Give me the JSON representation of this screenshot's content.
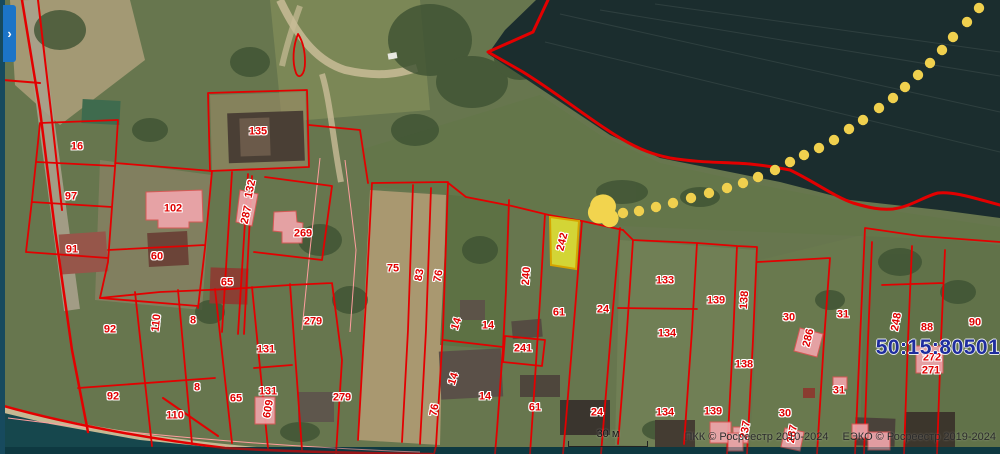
{
  "panel": {
    "expand_chevron": "›"
  },
  "map": {
    "quarter_label": "50:15:80501",
    "scale_bar_label": "30 м",
    "attribution": [
      "ПКК © Росреестр 2010-2024",
      "ЕЭКО © Росреестр 2019-2024"
    ],
    "selected_parcel": {
      "label": "242"
    },
    "colors": {
      "boundary_red": "#e30000",
      "label_red": "#e00000",
      "pink_building_fill": "#f2a6ad",
      "pink_building_stroke": "#e05555",
      "selected_fill": "#e6e632",
      "selected_stroke": "#d6a400",
      "route_dot": "#f0d04e",
      "water": "#1b2d2e",
      "quarter_navy": "#1f2d9e",
      "panel_blue": "#1c74c7"
    },
    "parcel_labels": [
      {
        "t": "16",
        "x": 77,
        "y": 147,
        "r": 0
      },
      {
        "t": "97",
        "x": 71,
        "y": 197,
        "r": 0
      },
      {
        "t": "102",
        "x": 173,
        "y": 209,
        "r": 0
      },
      {
        "t": "91",
        "x": 72,
        "y": 250,
        "r": 0
      },
      {
        "t": "60",
        "x": 157,
        "y": 257,
        "r": 0
      },
      {
        "t": "65",
        "x": 227,
        "y": 283,
        "r": 0
      },
      {
        "t": "132",
        "x": 251,
        "y": 189,
        "r": -78
      },
      {
        "t": "287",
        "x": 247,
        "y": 215,
        "r": -78
      },
      {
        "t": "135",
        "x": 258,
        "y": 132,
        "r": 0
      },
      {
        "t": "269",
        "x": 303,
        "y": 234,
        "r": 0
      },
      {
        "t": "92",
        "x": 110,
        "y": 330,
        "r": 0
      },
      {
        "t": "110",
        "x": 157,
        "y": 323,
        "r": -84
      },
      {
        "t": "8",
        "x": 193,
        "y": 321,
        "r": 0
      },
      {
        "t": "92",
        "x": 113,
        "y": 397,
        "r": 0
      },
      {
        "t": "110",
        "x": 175,
        "y": 416,
        "r": 0
      },
      {
        "t": "8",
        "x": 197,
        "y": 388,
        "r": 0
      },
      {
        "t": "65",
        "x": 236,
        "y": 399,
        "r": 0
      },
      {
        "t": "131",
        "x": 266,
        "y": 350,
        "r": 0
      },
      {
        "t": "131",
        "x": 268,
        "y": 392,
        "r": 0
      },
      {
        "t": "609",
        "x": 269,
        "y": 409,
        "r": -80
      },
      {
        "t": "279",
        "x": 313,
        "y": 322,
        "r": 0
      },
      {
        "t": "279",
        "x": 342,
        "y": 398,
        "r": 0
      },
      {
        "t": "75",
        "x": 393,
        "y": 269,
        "r": 0
      },
      {
        "t": "83",
        "x": 420,
        "y": 275,
        "r": -80
      },
      {
        "t": "76",
        "x": 439,
        "y": 276,
        "r": -80
      },
      {
        "t": "14",
        "x": 457,
        "y": 324,
        "r": -72
      },
      {
        "t": "14",
        "x": 488,
        "y": 326,
        "r": 0
      },
      {
        "t": "240",
        "x": 527,
        "y": 276,
        "r": -86
      },
      {
        "t": "242",
        "x": 563,
        "y": 242,
        "r": -76,
        "sel": true
      },
      {
        "t": "241",
        "x": 523,
        "y": 349,
        "r": 0
      },
      {
        "t": "14",
        "x": 454,
        "y": 379,
        "r": -72
      },
      {
        "t": "14",
        "x": 485,
        "y": 397,
        "r": 0
      },
      {
        "t": "76",
        "x": 435,
        "y": 410,
        "r": -80
      },
      {
        "t": "61",
        "x": 559,
        "y": 313,
        "r": 0
      },
      {
        "t": "61",
        "x": 535,
        "y": 408,
        "r": 0
      },
      {
        "t": "24",
        "x": 603,
        "y": 310,
        "r": 0
      },
      {
        "t": "24",
        "x": 597,
        "y": 413,
        "r": 0
      },
      {
        "t": "133",
        "x": 665,
        "y": 281,
        "r": 0
      },
      {
        "t": "134",
        "x": 667,
        "y": 334,
        "r": 0
      },
      {
        "t": "134",
        "x": 665,
        "y": 413,
        "r": 0
      },
      {
        "t": "139",
        "x": 716,
        "y": 301,
        "r": 0
      },
      {
        "t": "139",
        "x": 713,
        "y": 412,
        "r": 0
      },
      {
        "t": "138",
        "x": 745,
        "y": 300,
        "r": -86
      },
      {
        "t": "138",
        "x": 744,
        "y": 365,
        "r": 0
      },
      {
        "t": "237",
        "x": 746,
        "y": 430,
        "r": -80
      },
      {
        "t": "30",
        "x": 789,
        "y": 318,
        "r": 0
      },
      {
        "t": "30",
        "x": 785,
        "y": 414,
        "r": 0
      },
      {
        "t": "286",
        "x": 809,
        "y": 338,
        "r": -76
      },
      {
        "t": "287",
        "x": 793,
        "y": 434,
        "r": -80
      },
      {
        "t": "31",
        "x": 843,
        "y": 315,
        "r": 0
      },
      {
        "t": "31",
        "x": 839,
        "y": 391,
        "r": 0
      },
      {
        "t": "248",
        "x": 897,
        "y": 322,
        "r": -80
      },
      {
        "t": "88",
        "x": 927,
        "y": 328,
        "r": 0
      },
      {
        "t": "90",
        "x": 975,
        "y": 323,
        "r": 0
      },
      {
        "t": "272",
        "x": 932,
        "y": 358,
        "r": 0
      },
      {
        "t": "271",
        "x": 931,
        "y": 371,
        "r": 0
      }
    ],
    "route_dots": [
      [
        623,
        213
      ],
      [
        639,
        211
      ],
      [
        656,
        207
      ],
      [
        673,
        203
      ],
      [
        691,
        198
      ],
      [
        709,
        193
      ],
      [
        727,
        188
      ],
      [
        743,
        183
      ],
      [
        758,
        177
      ],
      [
        775,
        170
      ],
      [
        790,
        162
      ],
      [
        804,
        155
      ],
      [
        819,
        148
      ],
      [
        834,
        140
      ],
      [
        849,
        129
      ],
      [
        863,
        120
      ],
      [
        879,
        108
      ],
      [
        893,
        98
      ],
      [
        905,
        87
      ],
      [
        918,
        75
      ],
      [
        930,
        63
      ],
      [
        942,
        50
      ],
      [
        953,
        37
      ],
      [
        967,
        22
      ],
      [
        979,
        8
      ]
    ]
  }
}
